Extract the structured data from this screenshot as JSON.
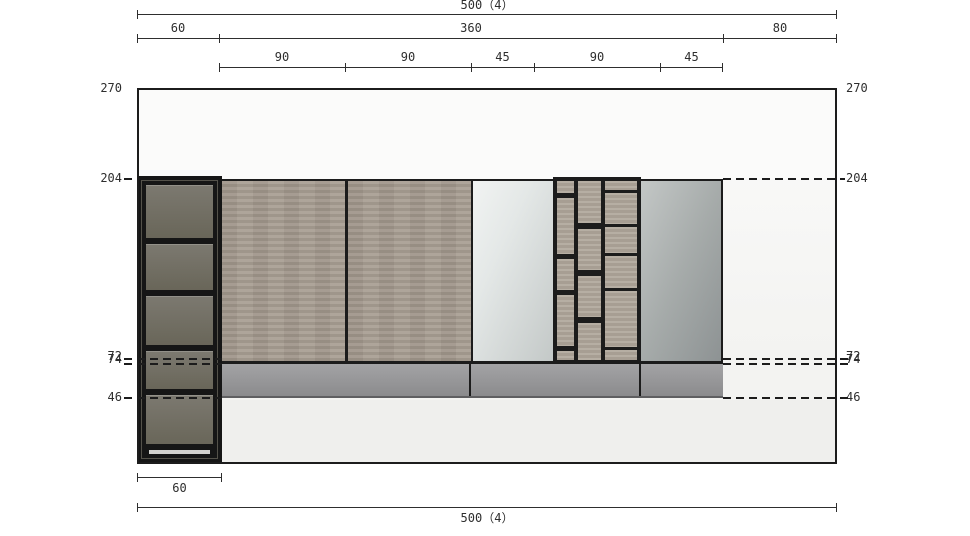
{
  "dims": {
    "top": {
      "row1": {
        "label": "500（4）"
      },
      "row2": {
        "labels": [
          "60",
          "360",
          "80"
        ]
      },
      "row3": {
        "labels": [
          "90",
          "90",
          "45",
          "90",
          "45"
        ]
      }
    },
    "bottom": {
      "row1": {
        "label": "60"
      },
      "row2": {
        "label": "500（4）"
      }
    },
    "left": {
      "labels": [
        "270",
        "204",
        "72",
        "74",
        "46"
      ]
    },
    "right": {
      "labels": [
        "270",
        "204",
        "72",
        "74",
        "46"
      ]
    }
  },
  "colors": {
    "line": "#1c1c1c",
    "dim": "#2e2e2e",
    "wall": "#f3f3f1",
    "wall_upper": "#fbfbfa",
    "floor": "#efefed",
    "wood": "#a49a8e",
    "wood_light": "#b0a79b",
    "mirror_a": "#e4e8e7",
    "mirror_b": "#c3c8c7",
    "panel_a": "#c3c7c6",
    "panel_b": "#8d9293",
    "cabinet_frame": "#161616",
    "cabinet_panel_a": "#7c7970",
    "cabinet_panel_b": "#696659",
    "band_a": "#a3a3a5",
    "band_b": "#8b8b8d",
    "toe": "#d3d2cf"
  }
}
